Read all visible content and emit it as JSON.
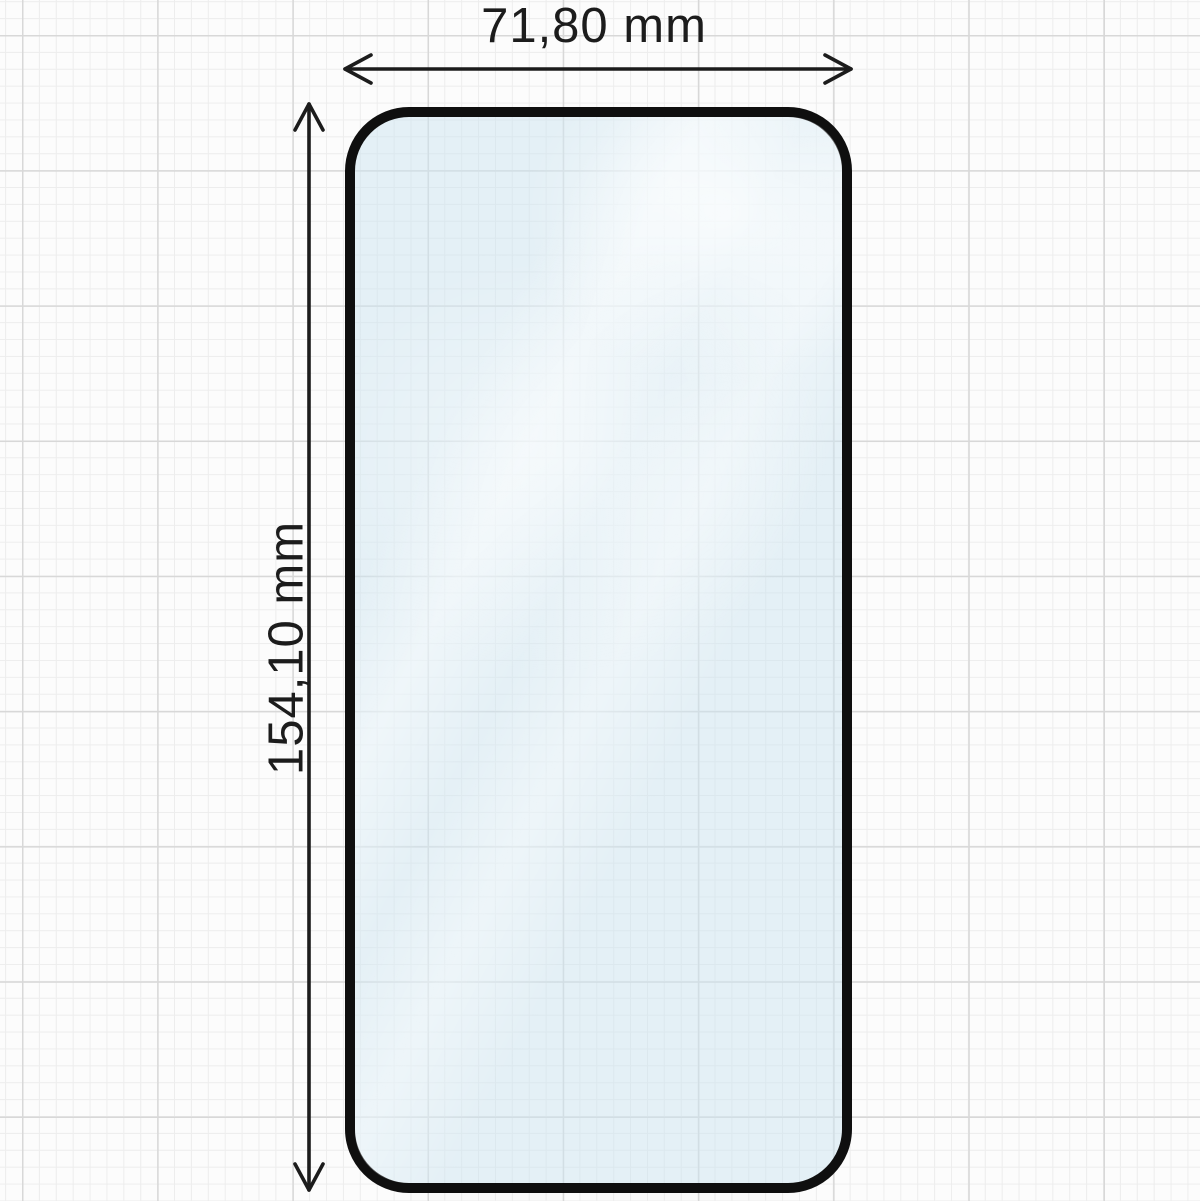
{
  "diagram": {
    "kind": "screen-protector-dimension-drawing"
  },
  "dimensions": {
    "width": {
      "label": "71,80 mm",
      "value": "71,80",
      "unit": "mm"
    },
    "height": {
      "label": "154,10 mm",
      "value": "154,10",
      "unit": "mm"
    }
  },
  "colors": {
    "background": "#fcfcfc",
    "grid_minor": "#ededed",
    "grid_major": "#d8d8d8",
    "outline": "#0f0f0f",
    "arrow": "#1c1c1c",
    "text": "#1c1c1c",
    "glass_tint": "rgba(205,229,239,0.52)"
  }
}
